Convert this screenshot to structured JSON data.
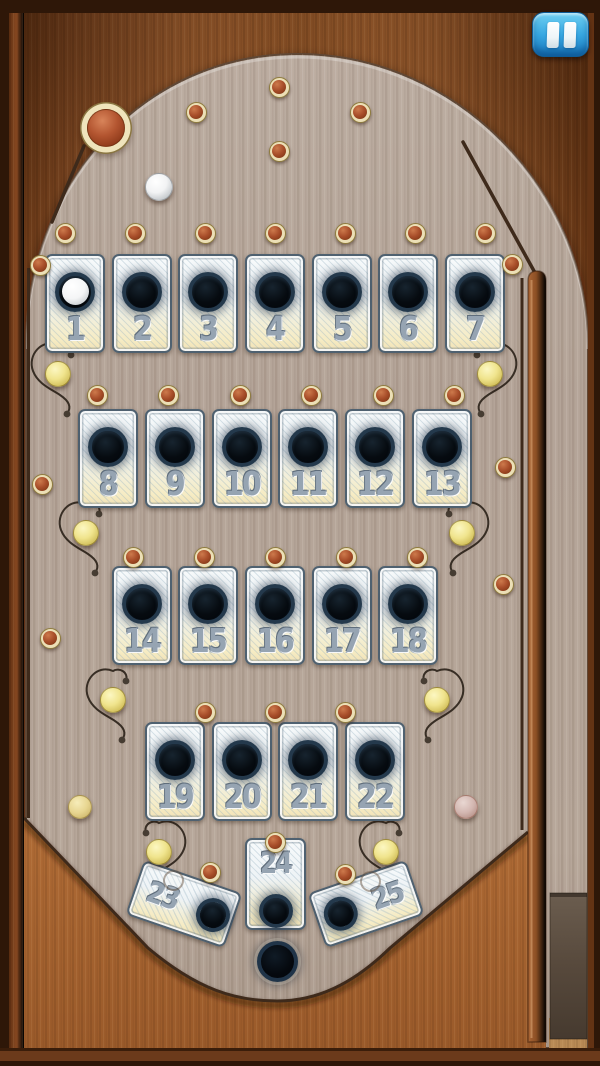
{
  "screen": {
    "kind": "pinball-bagatelle-board"
  },
  "ui": {
    "pause_button": {
      "icon": "pause-icon"
    }
  },
  "board": {
    "slot_labels": [
      "1",
      "2",
      "3",
      "4",
      "5",
      "6",
      "7",
      "8",
      "9",
      "10",
      "11",
      "12",
      "13",
      "14",
      "15",
      "16",
      "17",
      "18",
      "19",
      "20",
      "21",
      "22",
      "23",
      "24",
      "25"
    ],
    "slot_with_ball": "1",
    "colors": {
      "frame_dark": "#2e1708",
      "wood": "#9a5c2c",
      "board_surface": "#b4a498",
      "card_face": "#f5f8f9",
      "card_bottom_tint": "#f3e8c2",
      "card_border": "#51626f",
      "number_gray": "#96a4b2",
      "hole_black": "#070b0f",
      "hole_ring": "#24394c",
      "pin_ring_cream": "#ecdfb6",
      "pin_red": "#a84e2a",
      "ball_yellow": "#f0e48d",
      "ball_white": "#ffffff",
      "ball_pale_yellow": "#e9d98e",
      "ball_pink": "#d3b7b1",
      "big_ball_red": "#b35530",
      "pause_blue": "#2e9ede",
      "plunger_gray": "#57493c"
    },
    "big_pin_ball": {
      "x": 106,
      "y": 128,
      "r": 19
    },
    "pins": [
      {
        "x": 196,
        "y": 112
      },
      {
        "x": 279,
        "y": 87
      },
      {
        "x": 360,
        "y": 112
      },
      {
        "x": 279,
        "y": 151
      },
      {
        "x": 65,
        "y": 233
      },
      {
        "x": 135,
        "y": 233
      },
      {
        "x": 205,
        "y": 233
      },
      {
        "x": 275,
        "y": 233
      },
      {
        "x": 345,
        "y": 233
      },
      {
        "x": 415,
        "y": 233
      },
      {
        "x": 485,
        "y": 233
      },
      {
        "x": 40,
        "y": 265
      },
      {
        "x": 512,
        "y": 264
      },
      {
        "x": 97,
        "y": 395
      },
      {
        "x": 168,
        "y": 395
      },
      {
        "x": 240,
        "y": 395
      },
      {
        "x": 311,
        "y": 395
      },
      {
        "x": 383,
        "y": 395
      },
      {
        "x": 454,
        "y": 395
      },
      {
        "x": 42,
        "y": 484
      },
      {
        "x": 505,
        "y": 467
      },
      {
        "x": 133,
        "y": 557
      },
      {
        "x": 204,
        "y": 557
      },
      {
        "x": 275,
        "y": 557
      },
      {
        "x": 346,
        "y": 557
      },
      {
        "x": 417,
        "y": 557
      },
      {
        "x": 50,
        "y": 638
      },
      {
        "x": 503,
        "y": 584
      },
      {
        "x": 205,
        "y": 712
      },
      {
        "x": 275,
        "y": 712
      },
      {
        "x": 345,
        "y": 712
      },
      {
        "x": 275,
        "y": 842
      },
      {
        "x": 210,
        "y": 872
      },
      {
        "x": 345,
        "y": 874
      }
    ],
    "balls": [
      {
        "color": "white",
        "x": 159,
        "y": 187,
        "r": 14
      },
      {
        "color": "yellow",
        "x": 58,
        "y": 374,
        "r": 13
      },
      {
        "color": "yellow",
        "x": 490,
        "y": 374,
        "r": 13
      },
      {
        "color": "yellow",
        "x": 86,
        "y": 533,
        "r": 13
      },
      {
        "color": "yellow",
        "x": 462,
        "y": 533,
        "r": 13
      },
      {
        "color": "yellow",
        "x": 113,
        "y": 700,
        "r": 13
      },
      {
        "color": "yellow",
        "x": 437,
        "y": 700,
        "r": 13
      },
      {
        "color": "yellow",
        "x": 159,
        "y": 852,
        "r": 13
      },
      {
        "color": "yellow",
        "x": 386,
        "y": 852,
        "r": 13
      },
      {
        "color": "pale",
        "x": 80,
        "y": 807,
        "r": 12
      },
      {
        "color": "pink",
        "x": 466,
        "y": 807,
        "r": 12
      }
    ]
  }
}
